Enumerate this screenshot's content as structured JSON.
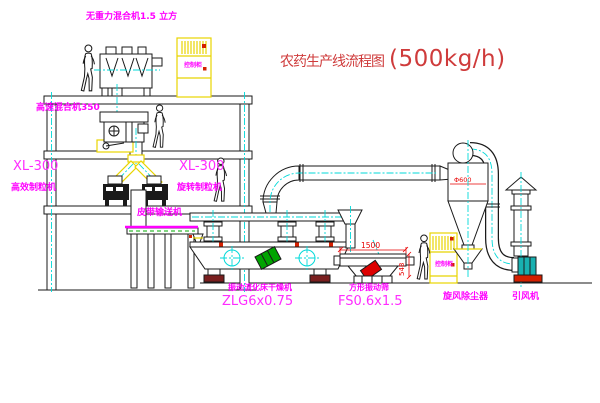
{
  "title": {
    "cn": "农药生产线流程图",
    "capacity": "(500kg/h)"
  },
  "labels": {
    "gravity_mixer": "无重力混合机1.5 立方",
    "high_speed_mixer": "高速混合机350",
    "granulator_left_model": "XL-300",
    "granulator_left_name": "高效制粒机",
    "granulator_right_model": "XL-300",
    "granulator_right_name": "旋转制粒机",
    "belt_conveyor": "皮带输送机",
    "dryer_name": "振动流化床干燥机",
    "dryer_model": "ZLG6x0.75",
    "sieve_name": "方形振动筛",
    "sieve_model": "FS0.6x1.5",
    "cyclone": "旋风除尘器",
    "fan": "引风机",
    "cabinet": "控制柜"
  },
  "dimensions": {
    "sieve_length_mm": "1500",
    "sieve_outlet_height_mm": "548",
    "cyclone_marking": "Φ600"
  },
  "colors": {
    "label_magenta": "#ff00ff",
    "title_red": "#cf3b3b",
    "centerline_cyan": "#00d9d9",
    "cad_yellow": "#e8d400",
    "accent_red": "#e80000",
    "motor_green": "#00a400",
    "fan_teal": "#18b0b0"
  }
}
